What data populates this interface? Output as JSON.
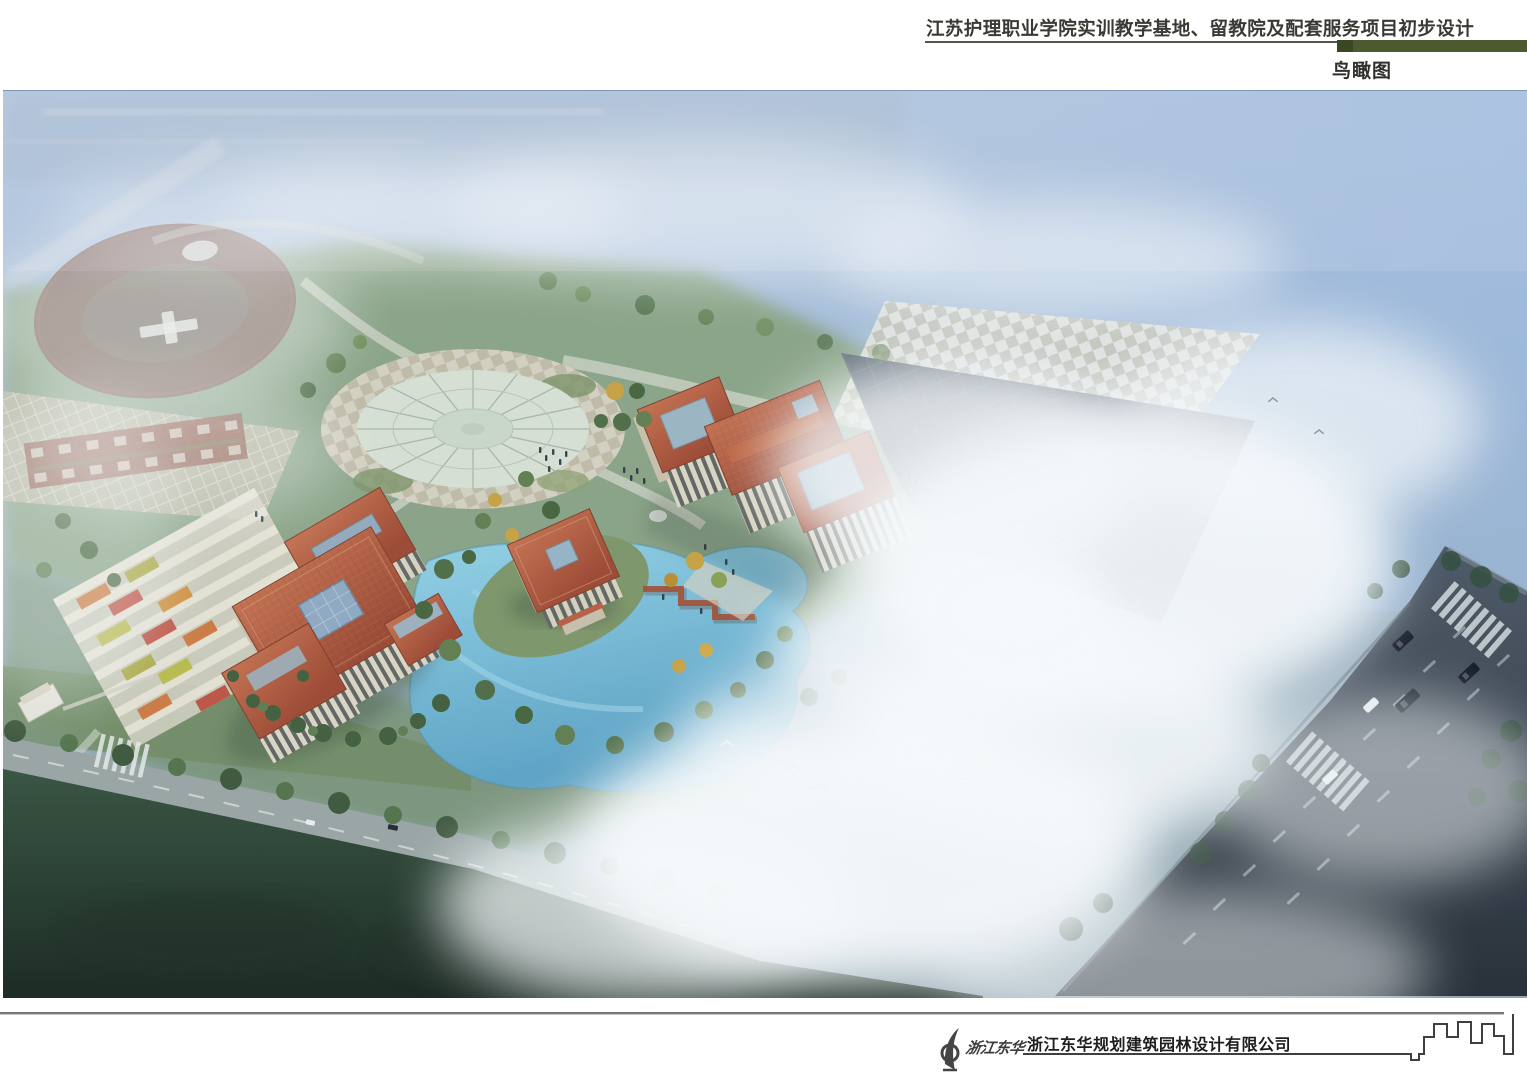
{
  "header": {
    "title": "江苏护理职业学院实训教学基地、留教院及配套服务项目初步设计",
    "view_label": "鸟瞰图",
    "accent_color": "#4d5a2f"
  },
  "rendering": {
    "description": "校园规划鸟瞰效果图：红瓦建筑群、圆形玻璃广场、运动场、湖面、城市道路，画面笼罩薄雾",
    "palette": {
      "sky": "#a7bedd",
      "roof": "#a8503a",
      "lake": "#68b0d2",
      "lawn": "#7f9769",
      "fog": "#f7fafc",
      "road": "#3a4450",
      "forest": "#223527"
    }
  },
  "footer": {
    "logo_text": "浙江东华",
    "company_name": "浙江东华规划建筑园林设计有限公司"
  }
}
